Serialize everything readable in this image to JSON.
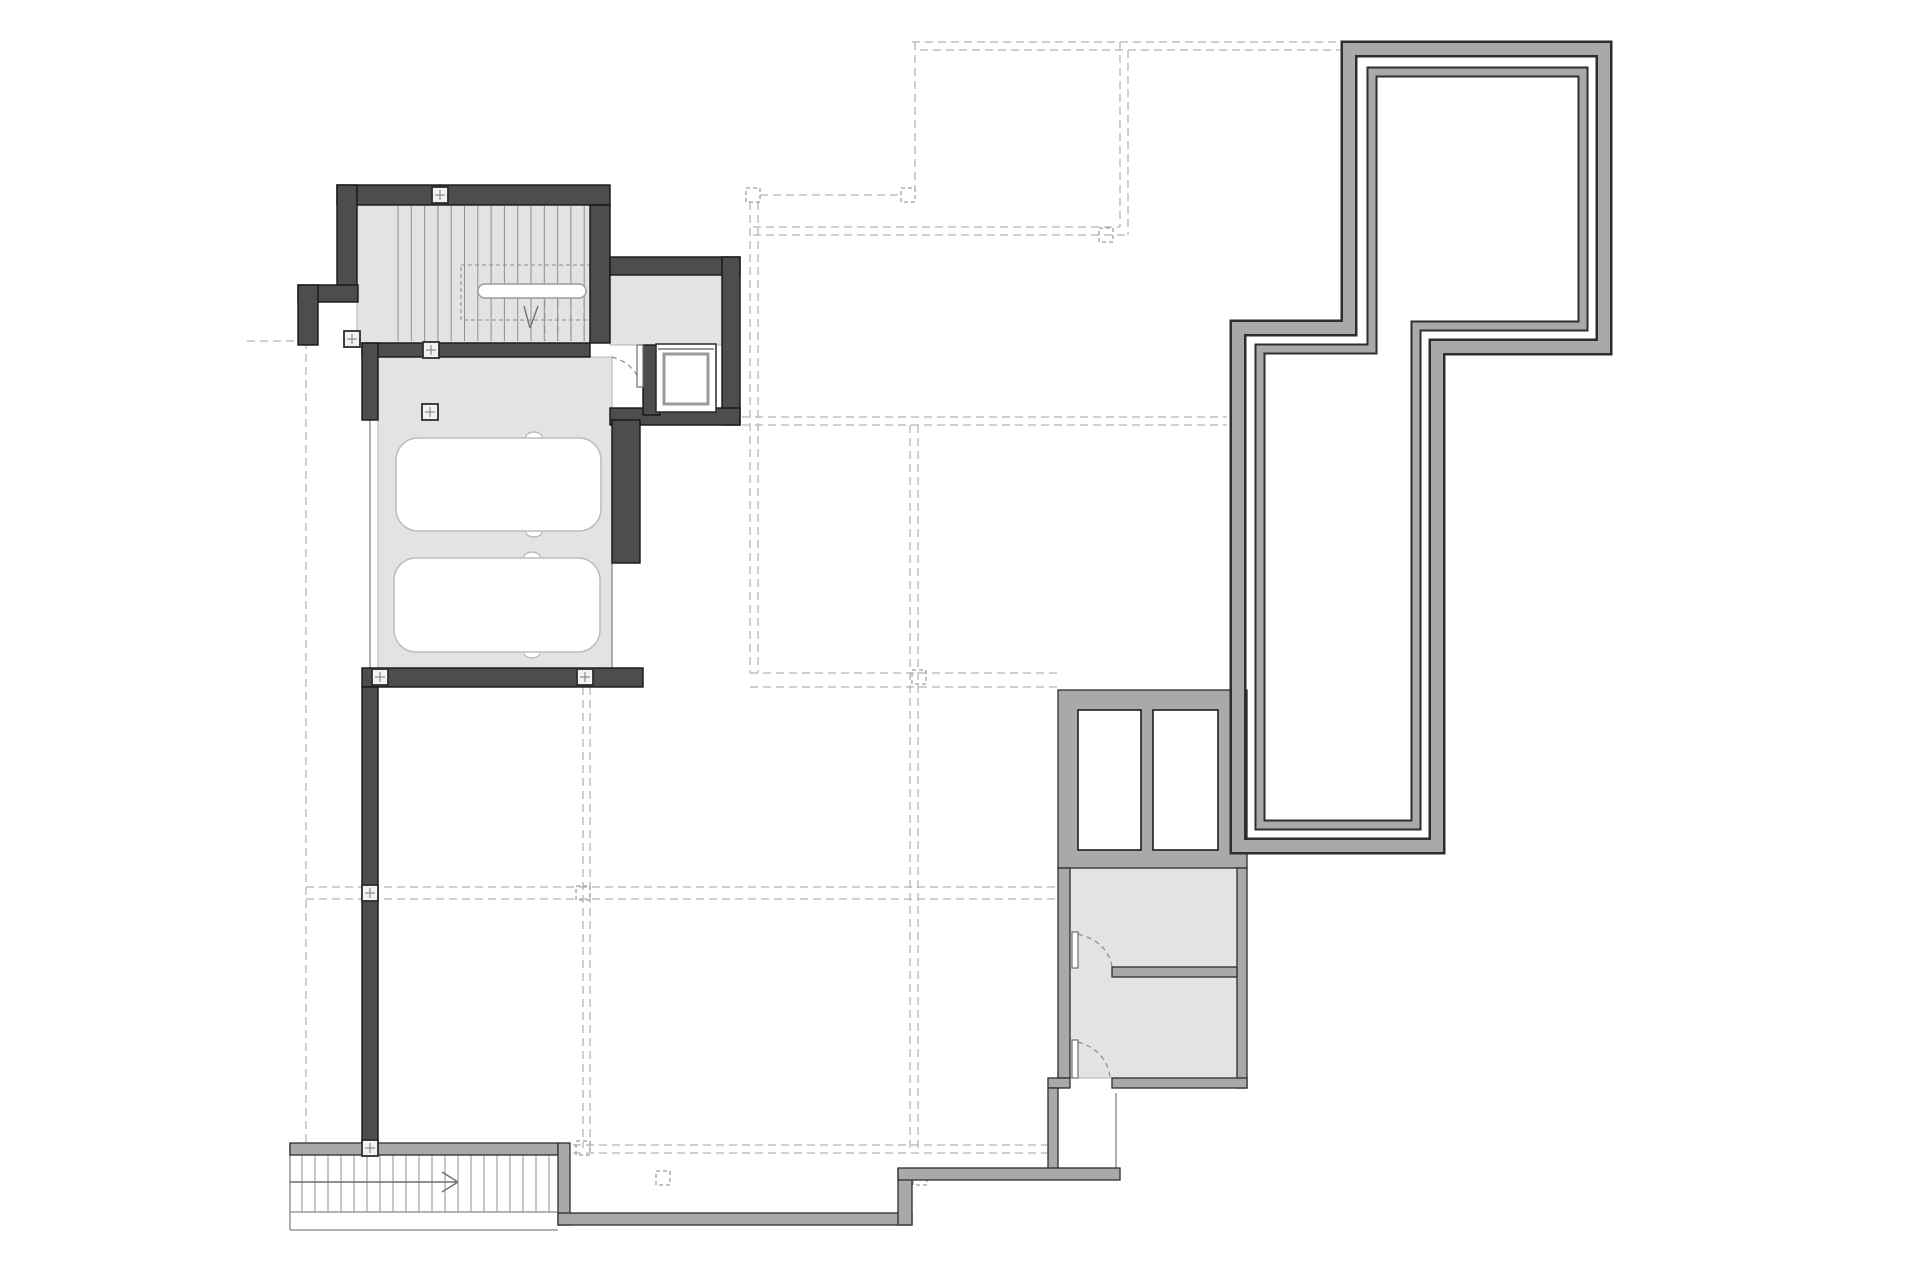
{
  "document": {
    "kind": "architectural-floor-plan",
    "visible_text": []
  },
  "plan": {
    "width": 1920,
    "height": 1280,
    "styles": {
      "bg": "#ffffff",
      "floor_fill": "#e3e3e3",
      "floor_edge": "#b4b4b4",
      "dark_wall": "#4d4d4d",
      "dark_edge": "#161616",
      "gray_wall": "#a9a9a9",
      "gray_edge": "#2e2e2e",
      "dash": "#b5b5b5",
      "dash_box": "#9e9e9e",
      "tread": "#8f8f8f",
      "thin": "#9b9b9b",
      "car_stroke": "#bdbdbd",
      "door": "#8d8d8d",
      "marker_fill": "#f2f2f2",
      "marker_edge": "#2d2d2d",
      "marker_cross": "#8a8a8a"
    },
    "floors": [
      {
        "x": 357,
        "y": 205,
        "w": 233,
        "h": 138
      },
      {
        "x": 610,
        "y": 275,
        "w": 112,
        "h": 70
      },
      {
        "x": 378,
        "y": 357,
        "w": 234,
        "h": 311
      },
      {
        "x": 1070,
        "y": 868,
        "w": 167,
        "h": 210
      }
    ],
    "dashed_lines": [
      {
        "x1": 306,
        "y1": 341,
        "x2": 306,
        "y2": 1148
      },
      {
        "x1": 247,
        "y1": 341,
        "x2": 306,
        "y2": 341
      },
      {
        "x1": 915,
        "y1": 42,
        "x2": 915,
        "y2": 188
      },
      {
        "x1": 760,
        "y1": 195,
        "x2": 901,
        "y2": 195
      },
      {
        "x1": 753,
        "y1": 227,
        "x2": 1120,
        "y2": 227
      },
      {
        "x1": 753,
        "y1": 235,
        "x2": 1128,
        "y2": 235
      },
      {
        "x1": 1120,
        "y1": 42,
        "x2": 1120,
        "y2": 227
      },
      {
        "x1": 1128,
        "y1": 50,
        "x2": 1128,
        "y2": 235
      },
      {
        "x1": 912,
        "y1": 42,
        "x2": 1342,
        "y2": 42
      },
      {
        "x1": 920,
        "y1": 50,
        "x2": 1342,
        "y2": 50
      },
      {
        "x1": 742,
        "y1": 417,
        "x2": 1227,
        "y2": 417
      },
      {
        "x1": 742,
        "y1": 425,
        "x2": 1227,
        "y2": 425
      },
      {
        "x1": 750,
        "y1": 202,
        "x2": 750,
        "y2": 673
      },
      {
        "x1": 758,
        "y1": 202,
        "x2": 758,
        "y2": 673
      },
      {
        "x1": 750,
        "y1": 673,
        "x2": 1058,
        "y2": 673
      },
      {
        "x1": 750,
        "y1": 687,
        "x2": 1058,
        "y2": 687
      },
      {
        "x1": 306,
        "y1": 887,
        "x2": 1058,
        "y2": 887
      },
      {
        "x1": 306,
        "y1": 899,
        "x2": 1058,
        "y2": 899
      },
      {
        "x1": 560,
        "y1": 1145,
        "x2": 1048,
        "y2": 1145
      },
      {
        "x1": 560,
        "y1": 1153,
        "x2": 1048,
        "y2": 1153
      },
      {
        "x1": 583,
        "y1": 687,
        "x2": 583,
        "y2": 1148
      },
      {
        "x1": 590,
        "y1": 687,
        "x2": 590,
        "y2": 1148
      },
      {
        "x1": 910,
        "y1": 425,
        "x2": 910,
        "y2": 1148
      },
      {
        "x1": 918,
        "y1": 425,
        "x2": 918,
        "y2": 1148
      },
      {
        "x1": 545,
        "y1": 300,
        "x2": 545,
        "y2": 341
      },
      {
        "x1": 558,
        "y1": 300,
        "x2": 558,
        "y2": 341
      },
      {
        "x1": 571,
        "y1": 300,
        "x2": 571,
        "y2": 341
      },
      {
        "x1": 584,
        "y1": 300,
        "x2": 584,
        "y2": 341
      }
    ],
    "dashed_boxes": [
      {
        "x": 901,
        "y": 188,
        "w": 14,
        "h": 14
      },
      {
        "x": 746,
        "y": 188,
        "w": 14,
        "h": 14
      },
      {
        "x": 1099,
        "y": 228,
        "w": 14,
        "h": 14
      },
      {
        "x": 912,
        "y": 670,
        "w": 14,
        "h": 14
      },
      {
        "x": 576,
        "y": 886,
        "w": 14,
        "h": 14
      },
      {
        "x": 576,
        "y": 1141,
        "w": 14,
        "h": 14
      },
      {
        "x": 656,
        "y": 1171,
        "w": 14,
        "h": 14
      },
      {
        "x": 913,
        "y": 1171,
        "w": 14,
        "h": 14
      },
      {
        "x": 461,
        "y": 265,
        "w": 130,
        "h": 55
      }
    ],
    "thin_lines": [
      {
        "x1": 612,
        "y1": 563,
        "x2": 612,
        "y2": 668
      },
      {
        "x1": 370,
        "y1": 420,
        "x2": 370,
        "y2": 668
      },
      {
        "x1": 1116,
        "y1": 1093,
        "x2": 1116,
        "y2": 1168
      },
      {
        "x1": 290,
        "y1": 1143,
        "x2": 290,
        "y2": 1230
      },
      {
        "x1": 290,
        "y1": 1230,
        "x2": 558,
        "y2": 1230
      },
      {
        "x1": 290,
        "y1": 1212,
        "x2": 558,
        "y2": 1212
      }
    ],
    "tread_groups": [
      {
        "x1": 398,
        "x2": 585,
        "step": 13.3,
        "y1": 206,
        "y2": 341
      },
      {
        "x1": 302,
        "x2": 549,
        "step": 13,
        "y1": 1155,
        "y2": 1212
      }
    ],
    "arrow_lines": [
      {
        "x1": 290,
        "y1": 1182,
        "x2": 456,
        "y2": 1182
      },
      {
        "x1": 442,
        "y1": 1172,
        "x2": 458,
        "y2": 1182
      },
      {
        "x1": 442,
        "y1": 1192,
        "x2": 458,
        "y2": 1182
      },
      {
        "x1": 524,
        "y1": 306,
        "x2": 530,
        "y2": 328
      },
      {
        "x1": 538,
        "y1": 306,
        "x2": 530,
        "y2": 328
      }
    ],
    "handrail": {
      "x": 478,
      "y": 284,
      "w": 108,
      "h": 14,
      "r": 7
    },
    "cars": [
      {
        "x": 396,
        "y": 438,
        "w": 205,
        "h": 93,
        "r": 22,
        "mirrors": [
          [
            534,
            437
          ],
          [
            534,
            532
          ]
        ]
      },
      {
        "x": 394,
        "y": 558,
        "w": 206,
        "h": 94,
        "r": 22,
        "mirrors": [
          [
            532,
            557
          ],
          [
            532,
            653
          ]
        ]
      }
    ],
    "dark_walls": [
      {
        "x": 337,
        "y": 185,
        "w": 273,
        "h": 20
      },
      {
        "x": 337,
        "y": 185,
        "w": 20,
        "h": 108
      },
      {
        "x": 298,
        "y": 285,
        "w": 60,
        "h": 17
      },
      {
        "x": 298,
        "y": 285,
        "w": 20,
        "h": 60
      },
      {
        "x": 362,
        "y": 343,
        "w": 228,
        "h": 14
      },
      {
        "x": 590,
        "y": 205,
        "w": 20,
        "h": 138
      },
      {
        "x": 610,
        "y": 257,
        "w": 130,
        "h": 18
      },
      {
        "x": 722,
        "y": 257,
        "w": 18,
        "h": 168
      },
      {
        "x": 610,
        "y": 408,
        "w": 130,
        "h": 17
      },
      {
        "x": 643,
        "y": 345,
        "w": 17,
        "h": 70
      },
      {
        "x": 612,
        "y": 420,
        "w": 28,
        "h": 143
      },
      {
        "x": 362,
        "y": 668,
        "w": 281,
        "h": 19
      },
      {
        "x": 362,
        "y": 343,
        "w": 16,
        "h": 77
      },
      {
        "x": 362,
        "y": 687,
        "w": 16,
        "h": 468
      }
    ],
    "gray_walls": [
      {
        "x": 1058,
        "y": 690,
        "w": 189,
        "h": 178
      },
      {
        "x": 1058,
        "y": 868,
        "w": 12,
        "h": 210
      },
      {
        "x": 1048,
        "y": 1078,
        "w": 22,
        "h": 10
      },
      {
        "x": 1048,
        "y": 1088,
        "w": 10,
        "h": 87
      },
      {
        "x": 1237,
        "y": 868,
        "w": 10,
        "h": 220
      },
      {
        "x": 1112,
        "y": 1078,
        "w": 135,
        "h": 10
      },
      {
        "x": 1112,
        "y": 967,
        "w": 125,
        "h": 10
      },
      {
        "x": 290,
        "y": 1143,
        "w": 268,
        "h": 12
      },
      {
        "x": 558,
        "y": 1143,
        "w": 12,
        "h": 82
      },
      {
        "x": 558,
        "y": 1213,
        "w": 354,
        "h": 12
      },
      {
        "x": 898,
        "y": 1170,
        "w": 14,
        "h": 55
      },
      {
        "x": 898,
        "y": 1168,
        "w": 222,
        "h": 12
      }
    ],
    "white_cells": [
      {
        "x": 1078,
        "y": 710,
        "w": 63,
        "h": 140
      },
      {
        "x": 1153,
        "y": 710,
        "w": 65,
        "h": 140
      }
    ],
    "loops": [
      {
        "pts": [
          [
            1349,
            49
          ],
          [
            1604,
            49
          ],
          [
            1604,
            347
          ],
          [
            1437,
            347
          ],
          [
            1437,
            846
          ],
          [
            1238,
            846
          ],
          [
            1238,
            328
          ],
          [
            1349,
            328
          ]
        ],
        "w_edge": 17,
        "w_fill": 12
      },
      {
        "pts": [
          [
            1372,
            72
          ],
          [
            1583,
            72
          ],
          [
            1583,
            326
          ],
          [
            1416,
            326
          ],
          [
            1416,
            825
          ],
          [
            1260,
            825
          ],
          [
            1260,
            349
          ],
          [
            1372,
            349
          ]
        ],
        "w_edge": 11,
        "w_fill": 7
      }
    ],
    "elevator": {
      "shaft": {
        "x": 656,
        "y": 344,
        "w": 60,
        "h": 68
      },
      "car": {
        "x": 664,
        "y": 354,
        "w": 44,
        "h": 50
      },
      "door_line": {
        "x1": 658,
        "y1": 349,
        "x2": 714,
        "y2": 349
      }
    },
    "doors": [
      {
        "leaf": {
          "x": 637,
          "y": 345,
          "w": 6,
          "h": 42
        },
        "arc": "M 612 357 Q 636 364 641 386"
      },
      {
        "leaf": {
          "x": 1072,
          "y": 932,
          "w": 6,
          "h": 36
        },
        "arc": "M 1078 934 Q 1108 942 1112 967"
      },
      {
        "leaf": {
          "x": 1072,
          "y": 1040,
          "w": 6,
          "h": 38
        },
        "arc": "M 1078 1042 Q 1106 1050 1110 1077"
      }
    ],
    "markers": [
      {
        "cx": 440,
        "cy": 195
      },
      {
        "cx": 352,
        "cy": 339
      },
      {
        "cx": 431,
        "cy": 350
      },
      {
        "cx": 430,
        "cy": 412
      },
      {
        "cx": 380,
        "cy": 677
      },
      {
        "cx": 585,
        "cy": 677
      },
      {
        "cx": 370,
        "cy": 893
      },
      {
        "cx": 370,
        "cy": 1148
      }
    ]
  }
}
